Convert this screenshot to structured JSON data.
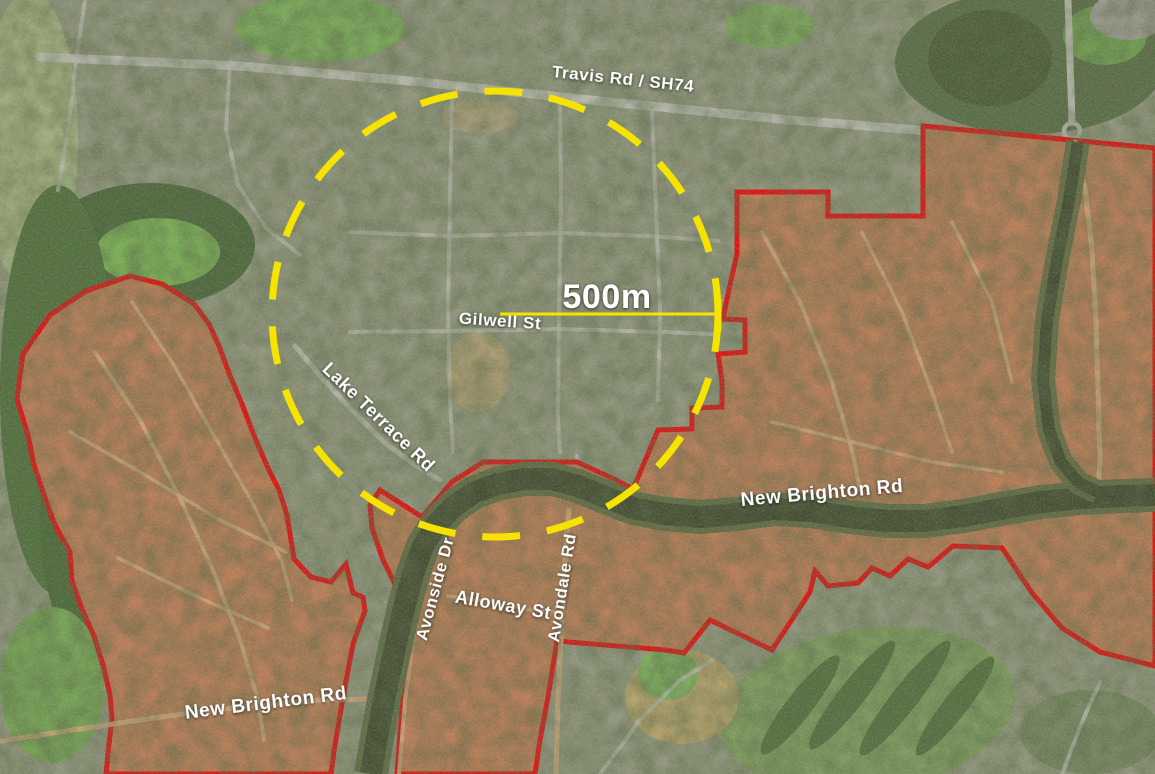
{
  "map": {
    "title": "Aerial map with 500m radius circle and residential red zone boundaries",
    "width": 1155,
    "height": 774,
    "colors": {
      "urban_base": "#8f947c",
      "boundary_red": "#dd1414",
      "annotation_yellow": "#f6e400",
      "zone_fill": "#b4835c",
      "zone_tint": "rgba(197,80,55,0.13)",
      "river_water": "#454d33",
      "river_bank": "#5f6b47",
      "road_urban": "#b7b7ac",
      "road_zone": "#c6a57a",
      "label_white": "#ffffff"
    },
    "regions": [
      {
        "name": "golf-strip-west",
        "type": "ellipse",
        "cx": 30,
        "cy": 140,
        "rx": 48,
        "ry": 150,
        "rotate": 0,
        "fill": "#9fab7d",
        "opacity": 1
      },
      {
        "name": "field-top-left",
        "type": "ellipse",
        "cx": 320,
        "cy": 28,
        "rx": 85,
        "ry": 34,
        "rotate": 0,
        "fill": "#7aa65a",
        "opacity": 1
      },
      {
        "name": "field-top-mid",
        "type": "ellipse",
        "cx": 770,
        "cy": 26,
        "rx": 45,
        "ry": 22,
        "rotate": 0,
        "fill": "#7aa35a",
        "opacity": 0.9
      },
      {
        "name": "forest-west",
        "type": "ellipse",
        "cx": 150,
        "cy": 245,
        "rx": 105,
        "ry": 62,
        "rotate": 0,
        "fill": "#4d683d",
        "opacity": 1
      },
      {
        "name": "field-bright-west",
        "type": "ellipse",
        "cx": 158,
        "cy": 252,
        "rx": 62,
        "ry": 34,
        "rotate": 0,
        "fill": "#79ab55",
        "opacity": 1
      },
      {
        "name": "forest-river-corridor-a",
        "type": "ellipse",
        "cx": 58,
        "cy": 390,
        "rx": 58,
        "ry": 205,
        "rotate": 0,
        "fill": "#53713f",
        "opacity": 1
      },
      {
        "name": "forest-river-corridor-b",
        "type": "ellipse",
        "cx": 88,
        "cy": 520,
        "rx": 48,
        "ry": 130,
        "rotate": 0,
        "fill": "#4d6a3b",
        "opacity": 1
      },
      {
        "name": "park-southwest",
        "type": "ellipse",
        "cx": 52,
        "cy": 685,
        "rx": 52,
        "ry": 78,
        "rotate": 0,
        "fill": "#76a156",
        "opacity": 1
      },
      {
        "name": "wetland-northeast",
        "type": "ellipse",
        "cx": 1030,
        "cy": 62,
        "rx": 135,
        "ry": 72,
        "rotate": 0,
        "fill": "#5c6e49",
        "opacity": 1
      },
      {
        "name": "marsh-northeast",
        "type": "ellipse",
        "cx": 990,
        "cy": 58,
        "rx": 62,
        "ry": 48,
        "rotate": 0,
        "fill": "#4d5e3c",
        "opacity": 1
      },
      {
        "name": "field-northeast",
        "type": "ellipse",
        "cx": 1105,
        "cy": 35,
        "rx": 42,
        "ry": 30,
        "rotate": 0,
        "fill": "#6f9b52",
        "opacity": 1
      },
      {
        "name": "cleared-ne-corner",
        "type": "ellipse",
        "cx": 1128,
        "cy": 16,
        "rx": 38,
        "ry": 24,
        "rotate": 0,
        "fill": "#9b9a8e",
        "opacity": 1
      },
      {
        "name": "golf-course-southeast",
        "type": "ellipse",
        "cx": 868,
        "cy": 710,
        "rx": 148,
        "ry": 82,
        "rotate": -8,
        "fill": "#7d9a5f",
        "opacity": 1
      },
      {
        "name": "golf-trees-row-1",
        "type": "ellipse",
        "cx": 800,
        "cy": 705,
        "rx": 13,
        "ry": 62,
        "rotate": 38,
        "fill": "#4e6a3c",
        "opacity": 0.85
      },
      {
        "name": "golf-trees-row-2",
        "type": "ellipse",
        "cx": 852,
        "cy": 695,
        "rx": 13,
        "ry": 68,
        "rotate": 38,
        "fill": "#4e6a3c",
        "opacity": 0.85
      },
      {
        "name": "golf-trees-row-3",
        "type": "ellipse",
        "cx": 905,
        "cy": 698,
        "rx": 13,
        "ry": 72,
        "rotate": 38,
        "fill": "#4e6a3c",
        "opacity": 0.85
      },
      {
        "name": "golf-trees-row-4",
        "type": "ellipse",
        "cx": 955,
        "cy": 706,
        "rx": 12,
        "ry": 62,
        "rotate": 38,
        "fill": "#4e6a3c",
        "opacity": 0.85
      },
      {
        "name": "field-tan-south",
        "type": "ellipse",
        "cx": 682,
        "cy": 697,
        "rx": 57,
        "ry": 47,
        "rotate": 0,
        "fill": "#b2a06b",
        "opacity": 1
      },
      {
        "name": "park-south-pocket",
        "type": "ellipse",
        "cx": 668,
        "cy": 673,
        "rx": 30,
        "ry": 27,
        "rotate": 0,
        "fill": "#7aa85c",
        "opacity": 1
      },
      {
        "name": "trees-southeast-corner",
        "type": "ellipse",
        "cx": 1090,
        "cy": 732,
        "rx": 70,
        "ry": 42,
        "rotate": 0,
        "fill": "#5f7a47",
        "opacity": 0.5
      },
      {
        "name": "school-field-in-circle",
        "type": "ellipse",
        "cx": 478,
        "cy": 372,
        "rx": 32,
        "ry": 40,
        "rotate": 0,
        "fill": "#a89a72",
        "opacity": 1
      },
      {
        "name": "bare-park-top-circle",
        "type": "ellipse",
        "cx": 480,
        "cy": 116,
        "rx": 38,
        "ry": 17,
        "rotate": 0,
        "fill": "#a59a78",
        "opacity": 1
      },
      {
        "name": "roundabout-anzac",
        "type": "ring",
        "cx": 1072,
        "cy": 131,
        "r": 8,
        "stroke": "#b7b7ac",
        "w": 4.5,
        "opacity": 1
      }
    ],
    "urban_roads": [
      {
        "name": "travis-rd-sh74-road",
        "points": "40,57 240,66 420,82 600,101 780,119 930,131 1030,139 1155,150",
        "w": 9,
        "opacity": 1
      },
      {
        "name": "anzac-dr-north-road",
        "points": "1068,0 1070,60 1072,122",
        "w": 7,
        "opacity": 1
      },
      {
        "name": "street-top-left-1",
        "points": "85,0 76,60 68,130 58,190",
        "w": 4,
        "opacity": 0.8
      },
      {
        "name": "street-top-left-2",
        "points": "230,62 226,130 238,185 266,228 300,255",
        "w": 4,
        "opacity": 0.8
      },
      {
        "name": "street-vertical-1",
        "points": "452,96 450,200 448,310 450,400 453,452",
        "w": 4,
        "opacity": 0.75
      },
      {
        "name": "street-vertical-2",
        "points": "560,96 561,200 559,310 558,420 560,452",
        "w": 4,
        "opacity": 0.75
      },
      {
        "name": "street-vertical-3",
        "points": "652,112 656,210 660,310 658,400",
        "w": 4,
        "opacity": 0.75
      },
      {
        "name": "street-horizontal-1",
        "points": "350,232 450,236 560,233 650,236 718,241",
        "w": 4,
        "opacity": 0.75
      },
      {
        "name": "gilwell-st-road",
        "points": "350,332 450,331 560,329 660,332 715,334",
        "w": 4,
        "opacity": 0.8
      },
      {
        "name": "lake-terrace-rd-road",
        "points": "295,346 322,378 352,410 385,443 415,465 440,480",
        "w": 5,
        "opacity": 0.9
      },
      {
        "name": "river-bridge-road",
        "points": "577,456 584,493",
        "w": 4,
        "opacity": 0.9
      },
      {
        "name": "street-southeast-1",
        "points": "600,774 640,720 680,680 712,660",
        "w": 4,
        "opacity": 0.8
      },
      {
        "name": "street-southeast-2",
        "points": "1062,774 1082,722 1100,682",
        "w": 4,
        "opacity": 0.8
      }
    ],
    "zones": [
      {
        "name": "west-residential-red-zone",
        "points": "130,276 162,284 194,304 209,324 219,346 229,373 242,404 255,438 268,468 279,490 287,515 291,540 294,559 311,577 331,582 346,564 353,593 363,597 365,611 353,644 346,681 339,721 334,751 331,774 106,774 109,744 112,719 110,695 103,665 94,636 82,609 72,581 70,552 55,525 44,495 34,465 28,435 17,399 23,354 50,315 86,291"
      },
      {
        "name": "east-residential-red-zone",
        "points": "923,126 1155,148 1155,666 1100,652 1062,628 1032,593 1002,548 953,546 928,567 908,559 890,576 872,568 858,583 828,586 815,571 810,592 772,650 710,620 684,653 665,650 557,641 548,697 540,740 535,774 397,774 402,706 409,661 415,622 400,612 396,586 383,560 372,528 370,505 380,490 422,517 452,482 483,462 577,462 614,479 633,489 658,430 692,429 692,408 722,407 722,382 718,354 745,352 745,320 723,319 729,289 737,254 737,192 828,192 828,216 923,216"
      }
    ],
    "zone_roads": [
      {
        "name": "new-brighton-rd-east-road",
        "points": "640,502 700,507 760,504 830,507 900,514 960,510 1030,501 1100,495 1155,493",
        "w": 5
      },
      {
        "name": "new-brighton-rd-south-road",
        "points": "0,741 80,729 160,717 240,707 320,700 385,699",
        "w": 5
      },
      {
        "name": "avondale-rd-road",
        "points": "556,774 558,700 561,640 564,580 567,530 569,510",
        "w": 5
      },
      {
        "name": "avonside-dr-road",
        "points": "399,774 405,700 413,640 421,598 430,560 440,532",
        "w": 4
      },
      {
        "name": "alloway-st-road",
        "points": "448,596 490,602 532,610 556,612",
        "w": 3.5
      },
      {
        "name": "anzac-dr-through-zone",
        "points": "1075,142 1085,190 1092,250 1096,320 1098,390 1100,460 1098,492",
        "w": 5
      },
      {
        "name": "west-zone-road-1",
        "points": "95,352 140,420 180,498 212,568 240,640 258,700 264,740",
        "w": 4
      },
      {
        "name": "west-zone-road-2",
        "points": "132,302 172,362 212,432 252,502 282,562 292,600",
        "w": 3.5
      },
      {
        "name": "west-zone-road-3",
        "points": "70,432 140,472 220,520 286,552",
        "w": 3.5
      },
      {
        "name": "west-zone-road-4",
        "points": "118,558 200,598 268,628",
        "w": 3.5
      },
      {
        "name": "east-zone-road-1",
        "points": "762,232 800,302 832,382 852,450 860,490",
        "w": 4
      },
      {
        "name": "east-zone-road-2",
        "points": "862,232 902,312 932,392 952,452",
        "w": 3.5
      },
      {
        "name": "east-zone-road-3",
        "points": "772,422 852,442 932,462 1002,472",
        "w": 3.5
      },
      {
        "name": "east-zone-road-4",
        "points": "952,222 992,302 1012,382",
        "w": 3.5
      }
    ],
    "river": {
      "main": "371,774 377,738 384,700 392,662 399,630 405,604 413,574 423,546 437,524 453,507 473,493 497,484 524,479 552,479 578,486 605,497 633,508 665,514 700,517 737,514 773,509 811,511 849,517 887,521 925,521 963,516 1001,509 1041,502 1081,498 1121,496 1155,495",
      "main_bank_w": 34,
      "main_water_w": 22,
      "side": "1078,142 1069,200 1057,260 1047,320 1043,380 1049,430 1061,462 1079,483 1098,492",
      "side_bank_w": 24,
      "side_water_w": 12
    },
    "circle": {
      "cx": 495,
      "cy": 314,
      "r": 223,
      "stroke_w": 7,
      "dash": "38 27"
    },
    "scale": {
      "x1": 500,
      "y1": 314,
      "x2": 718,
      "y2": 314,
      "line_w": 3,
      "tick_x": 718,
      "tick_y1": 299,
      "tick_y2": 331,
      "tick_w": 7
    },
    "labels": [
      {
        "name": "road-label-travis-rd-sh74",
        "text": "Travis Rd / SH74",
        "x": 623,
        "y": 80,
        "rotate": 6,
        "size": 17
      },
      {
        "name": "scale-label-500m",
        "text": "500m",
        "x": 607,
        "y": 299,
        "rotate": 0,
        "size": 34
      },
      {
        "name": "road-label-gilwell-st",
        "text": "Gilwell St",
        "x": 500,
        "y": 322,
        "rotate": 4,
        "size": 17
      },
      {
        "name": "road-label-lake-terrace-rd",
        "text": "Lake Terrace Rd",
        "x": 378,
        "y": 418,
        "rotate": 44,
        "size": 18
      },
      {
        "name": "road-label-new-brighton-rd-east",
        "text": "New Brighton Rd",
        "x": 822,
        "y": 494,
        "rotate": -5,
        "size": 19
      },
      {
        "name": "road-label-avonside-dr",
        "text": "Avonside Dr",
        "x": 436,
        "y": 589,
        "rotate": -75,
        "size": 17
      },
      {
        "name": "road-label-alloway-st",
        "text": "Alloway St",
        "x": 503,
        "y": 606,
        "rotate": 10,
        "size": 18
      },
      {
        "name": "road-label-avondale-rd",
        "text": "Avondale Rd",
        "x": 563,
        "y": 588,
        "rotate": -81,
        "size": 17
      },
      {
        "name": "road-label-new-brighton-rd-south",
        "text": "New Brighton Rd",
        "x": 266,
        "y": 704,
        "rotate": -7,
        "size": 19
      }
    ]
  }
}
